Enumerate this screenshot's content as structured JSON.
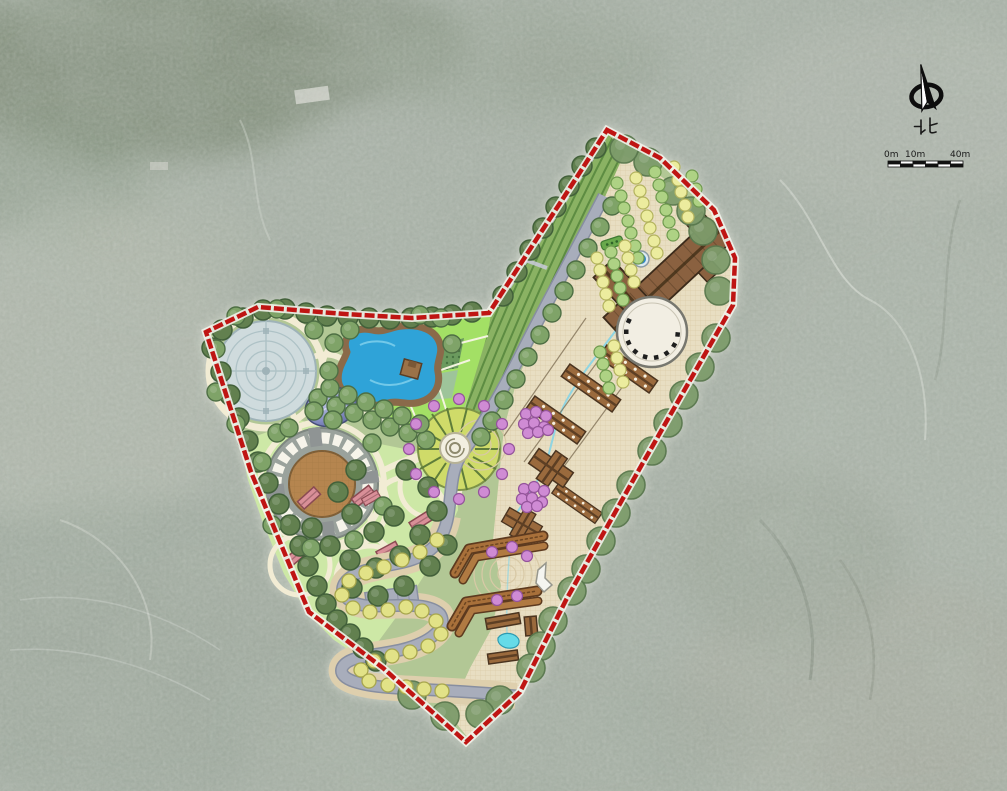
{
  "meta": {
    "kind": "landscape-masterplan-over-aerial-photo",
    "description": "Colored site master plan of a park and agritourism farm drawn over a muted aerial photograph, bounded by a red dashed property line"
  },
  "compass": {
    "north_label": "北"
  },
  "scale_bar": {
    "labels": [
      "0m",
      "10m",
      "40m"
    ]
  },
  "palette": {
    "bg_aerial": "#a7b0a6",
    "site_base": "#b2c795",
    "boundary_red": "#bf1513",
    "road_grey": "#a8adbb",
    "road_light": "#c9cada",
    "plaza_tan": "#e8dec2",
    "terrace_green": "#8ab263",
    "lawn_green": "#cde8a6",
    "field_bright": "#a3e065",
    "water_blue": "#2fa3d8",
    "pond_edge_brown": "#8a6a4a",
    "tree_dark": "#62804f",
    "tree_mid": "#7fa368",
    "tree_sage": "#7d9b6b",
    "tree_yellow": "#e2e287",
    "tree_magenta": "#cf8bd4",
    "tree_row_green": "#aed284",
    "tree_row_yellow": "#ecec9e",
    "building_brown": "#8a6140",
    "lodge_brown": "#9a6a3d",
    "pavilion_pink": "#d98f98",
    "amphitheater_stage": "#b5854f",
    "dome_purple": "#8890c4",
    "plaza_circle_grey": "#cfdbdd",
    "path_cream": "#f2ecd4"
  },
  "features": {
    "site": [
      "site-boundary",
      "main-road",
      "serpentine-road",
      "parking-area",
      "road-exit"
    ],
    "west_park": [
      "circular-water-plaza",
      "kidney-pond",
      "pond-deck",
      "blue-dome",
      "amphitheater",
      "lawn-cells",
      "pink-pavilions",
      "orchard-field-plots"
    ],
    "center": [
      "ring-plaza",
      "flower-wedge-beds",
      "magenta-tree-ring"
    ],
    "east_farm": [
      "terraced-fields",
      "orchard-tree-rows",
      "main-hall-building",
      "spiral-plaza",
      "fountain",
      "flower-bed",
      "guest-lodges",
      "farm-houses",
      "chevron-planter-terraces",
      "tent-structure",
      "service-buildings",
      "small-pond",
      "stream",
      "paved-plaza-grid"
    ]
  }
}
